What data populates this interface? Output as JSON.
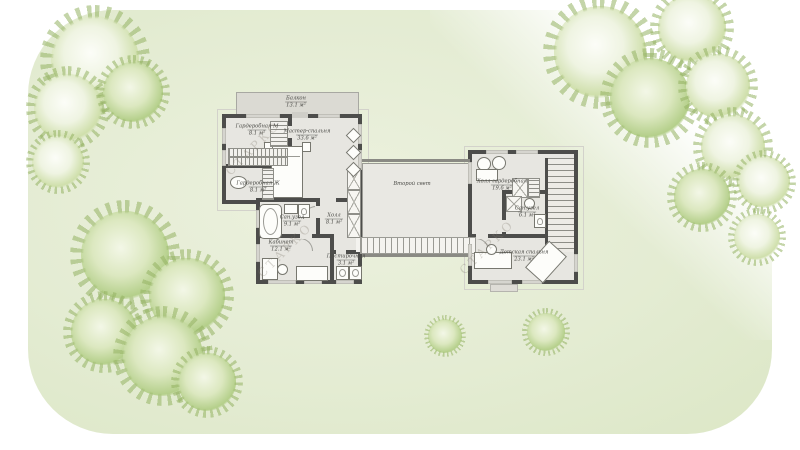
{
  "plan": {
    "watermark": "СТАРКО",
    "rooms": {
      "balcony": {
        "label": "Балкон",
        "area": "13.1 м²"
      },
      "wardrobe_m": {
        "label": "Гардеробная М",
        "area": "8.1 м²"
      },
      "master_bedroom": {
        "label": "Мастер-спальня",
        "area": "33.6 м²"
      },
      "wardrobe_f": {
        "label": "Гардеробная Ж",
        "area": "8.1 м²"
      },
      "bathroom_master": {
        "label": "Сан.узел",
        "area": "9.1 м²"
      },
      "hall": {
        "label": "Холл",
        "area": "8.1 м²"
      },
      "office": {
        "label": "Кабинет",
        "area": "12.1 м²"
      },
      "laundry": {
        "label": "Постирочная",
        "area": "3.1 м²"
      },
      "void": {
        "label": "Второй свет"
      },
      "hall_wardrobe": {
        "label": "Холл-гардеробная",
        "area": "19.6 м²"
      },
      "bathroom_kids": {
        "label": "Сан.узел",
        "area": "6.1 м²"
      },
      "kids_bedroom": {
        "label": "Детская спальня",
        "area": "23.1 м²"
      }
    }
  },
  "colors": {
    "wall": "#4d4d4b",
    "floor": "#e7e6e1",
    "balcony": "#dbdad3",
    "lawn": "#e4ecd3",
    "tree_green": "#b4cf8a"
  }
}
